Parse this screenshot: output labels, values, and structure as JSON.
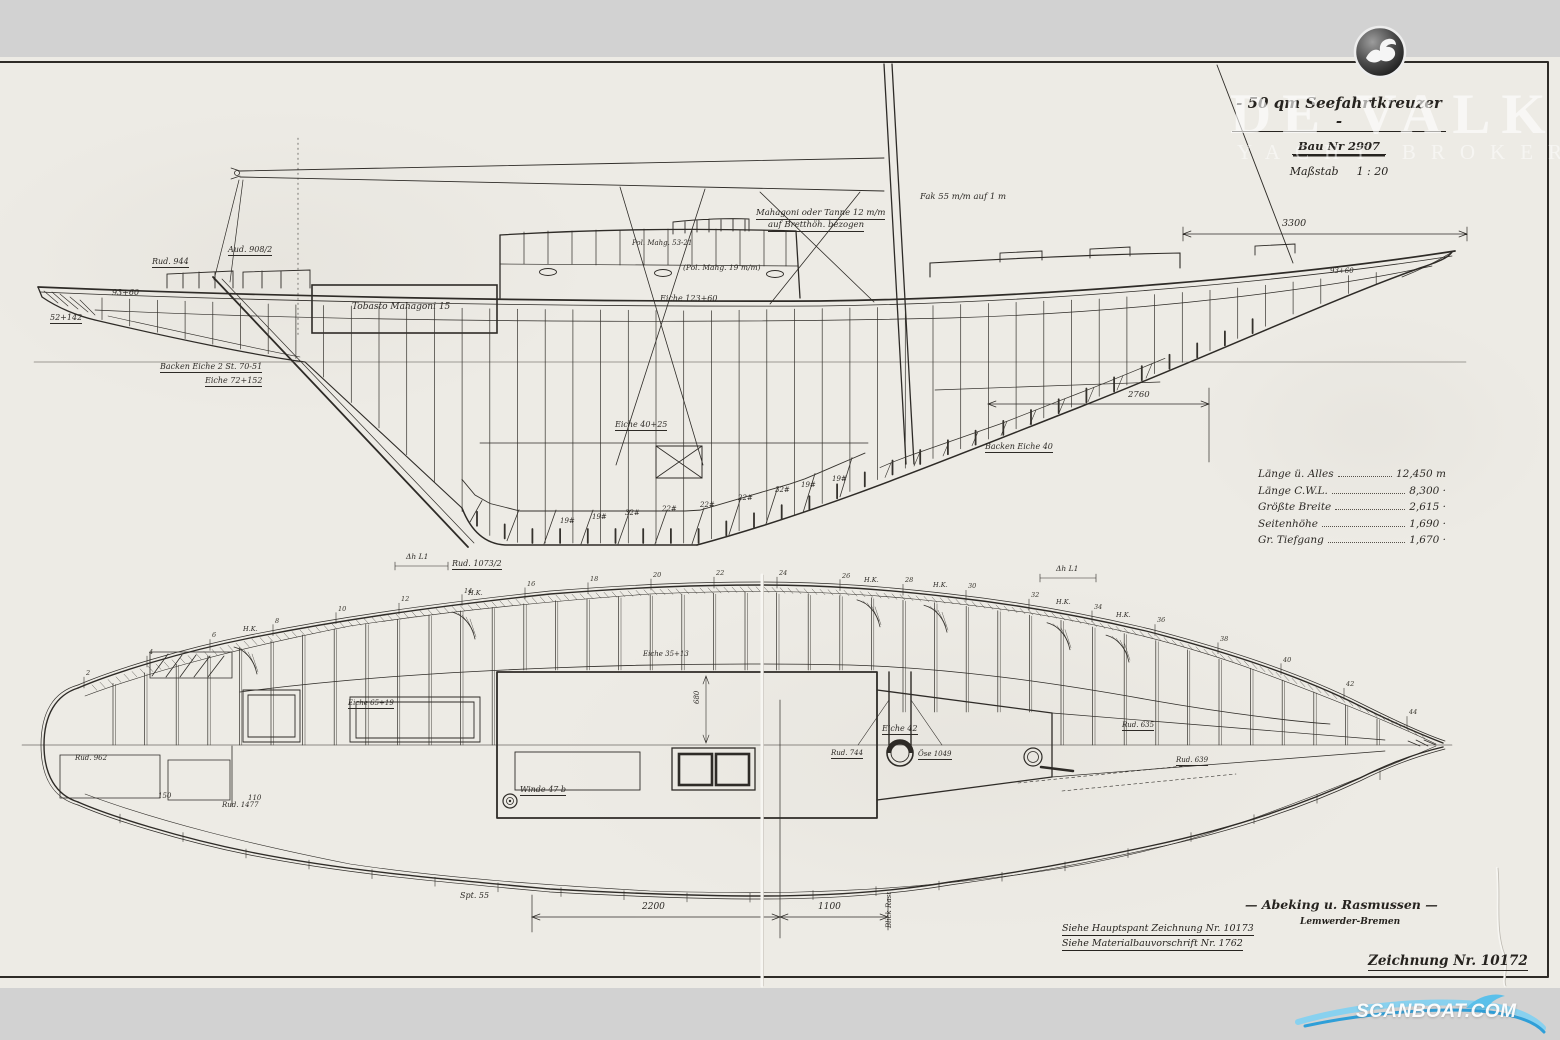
{
  "title_block": {
    "title": "- 50 qm Seefahrtkreuzer -",
    "build_no": "Bau Nr 2907",
    "scale_label": "Maßstab",
    "scale_value": "1 : 20"
  },
  "specs": {
    "rows": [
      {
        "label": "Länge ü. Alles",
        "value": "12,450 m"
      },
      {
        "label": "Länge C.W.L.",
        "value": "8,300 ·"
      },
      {
        "label": "Größte Breite",
        "value": "2,615 ·"
      },
      {
        "label": "Seitenhöhe",
        "value": "1,690 ·"
      },
      {
        "label": "Gr. Tiefgang",
        "value": "1,670 ·"
      }
    ]
  },
  "footer": {
    "firm": "— Abeking u. Rasmussen —",
    "firm_city": "Lemwerder-Bremen",
    "ref1": "Siehe Hauptspant Zeichnung Nr. 10173",
    "ref2": "Siehe Materialbauvorschrift Nr. 1762",
    "drawing_no": "Zeichnung Nr. 10172"
  },
  "watermark": {
    "brand": "DE VALK",
    "brand_sub": "YACHT BROKERS",
    "scanboat": "SCANBOAT.COM",
    "scanboat_blue": "#3aa9de",
    "bird_icon": "seagull-icon"
  },
  "plan_frame_numbers": [
    "2",
    "4",
    "6",
    "8",
    "10",
    "12",
    "14",
    "16",
    "18",
    "20",
    "22",
    "24",
    "26",
    "28",
    "30",
    "32",
    "34",
    "36",
    "38",
    "40",
    "42",
    "44"
  ],
  "annotations": [
    {
      "text": "Rud. 944",
      "x": 152,
      "y": 258,
      "s": 8,
      "u": true
    },
    {
      "text": "Aud. 908/2",
      "x": 228,
      "y": 246,
      "s": 8,
      "u": true
    },
    {
      "text": "93+60",
      "x": 112,
      "y": 289,
      "s": 8
    },
    {
      "text": "52+142",
      "x": 50,
      "y": 314,
      "s": 8,
      "u": true
    },
    {
      "text": "Backen Eiche 2 St. 70-51",
      "x": 160,
      "y": 363,
      "s": 8,
      "u": true
    },
    {
      "text": "Eiche 72+152",
      "x": 205,
      "y": 377,
      "s": 8,
      "u": true
    },
    {
      "text": "Tobasto Mahagoni 15",
      "x": 352,
      "y": 303,
      "s": 9
    },
    {
      "text": "Pol. Mahg. 53-21",
      "x": 632,
      "y": 240,
      "s": 7
    },
    {
      "text": "(Pol. Mahg. 19 m/m)",
      "x": 683,
      "y": 264,
      "s": 7.5
    },
    {
      "text": "Mahagoni oder Tanne 12 m/m",
      "x": 756,
      "y": 209,
      "s": 8.5,
      "u": true
    },
    {
      "text": "auf Bretthöh. bezogen",
      "x": 768,
      "y": 221,
      "s": 8.5,
      "u": true
    },
    {
      "text": "Fak 55 m/m auf 1 m",
      "x": 920,
      "y": 193,
      "s": 8.5
    },
    {
      "text": "Eiche 123+60",
      "x": 660,
      "y": 295,
      "s": 8
    },
    {
      "text": "3300",
      "x": 1282,
      "y": 219,
      "s": 9.5
    },
    {
      "text": "Eiche 40+25",
      "x": 615,
      "y": 421,
      "s": 8,
      "u": true
    },
    {
      "text": "Backen Eiche 40",
      "x": 985,
      "y": 443,
      "s": 8,
      "u": true
    },
    {
      "text": "2760",
      "x": 1128,
      "y": 391,
      "s": 8.5
    },
    {
      "text": "Δh L1",
      "x": 406,
      "y": 553,
      "s": 7.5
    },
    {
      "text": "Rud. 1073/2",
      "x": 452,
      "y": 560,
      "s": 8,
      "u": true
    },
    {
      "text": "Δh L1",
      "x": 1056,
      "y": 565,
      "s": 7.5
    },
    {
      "text": "93+60",
      "x": 1330,
      "y": 268,
      "s": 7
    },
    {
      "text": "19#",
      "x": 560,
      "y": 518,
      "s": 7
    },
    {
      "text": "19#",
      "x": 592,
      "y": 514,
      "s": 7
    },
    {
      "text": "32#",
      "x": 625,
      "y": 510,
      "s": 7
    },
    {
      "text": "22#",
      "x": 662,
      "y": 506,
      "s": 7
    },
    {
      "text": "22#",
      "x": 700,
      "y": 502,
      "s": 7
    },
    {
      "text": "22#",
      "x": 738,
      "y": 495,
      "s": 7
    },
    {
      "text": "32#",
      "x": 775,
      "y": 487,
      "s": 7
    },
    {
      "text": "19#",
      "x": 801,
      "y": 482,
      "s": 7
    },
    {
      "text": "19#",
      "x": 832,
      "y": 476,
      "s": 7
    },
    {
      "text": "Eiche 35+13",
      "x": 643,
      "y": 651,
      "s": 7
    },
    {
      "text": "Eiche 65+19",
      "x": 348,
      "y": 700,
      "s": 7,
      "u": true
    },
    {
      "text": "Eiche 42",
      "x": 882,
      "y": 725,
      "s": 8,
      "u": true
    },
    {
      "text": "Rud. 744",
      "x": 831,
      "y": 750,
      "s": 7,
      "u": true
    },
    {
      "text": "Öse 1049",
      "x": 918,
      "y": 751,
      "s": 7,
      "u": true
    },
    {
      "text": "Rud. 635",
      "x": 1122,
      "y": 722,
      "s": 7,
      "u": true
    },
    {
      "text": "Rud. 639",
      "x": 1176,
      "y": 757,
      "s": 7,
      "u": true
    },
    {
      "text": "Winde 47 b",
      "x": 520,
      "y": 786,
      "s": 8,
      "u": true
    },
    {
      "text": "Rud. 962",
      "x": 75,
      "y": 755,
      "s": 7
    },
    {
      "text": "Rud. 1477",
      "x": 222,
      "y": 802,
      "s": 7
    },
    {
      "text": "150",
      "x": 158,
      "y": 793,
      "s": 7
    },
    {
      "text": "110",
      "x": 248,
      "y": 795,
      "s": 7
    },
    {
      "text": "680",
      "x": 694,
      "y": 704,
      "s": 7,
      "r": -90
    },
    {
      "text": "2200",
      "x": 642,
      "y": 903,
      "s": 9
    },
    {
      "text": "1100",
      "x": 818,
      "y": 903,
      "s": 9
    },
    {
      "text": "Spt. 55",
      "x": 460,
      "y": 892,
      "s": 8
    },
    {
      "text": "Blick Rast",
      "x": 886,
      "y": 928,
      "s": 7,
      "r": -90
    },
    {
      "text": "H.K.",
      "x": 243,
      "y": 626,
      "s": 6.5
    },
    {
      "text": "H.K.",
      "x": 468,
      "y": 590,
      "s": 6.5
    },
    {
      "text": "H.K.",
      "x": 864,
      "y": 577,
      "s": 6.5
    },
    {
      "text": "H.K.",
      "x": 933,
      "y": 582,
      "s": 6.5
    },
    {
      "text": "H.K.",
      "x": 1056,
      "y": 599,
      "s": 6.5
    },
    {
      "text": "H.K.",
      "x": 1116,
      "y": 612,
      "s": 6.5
    }
  ]
}
